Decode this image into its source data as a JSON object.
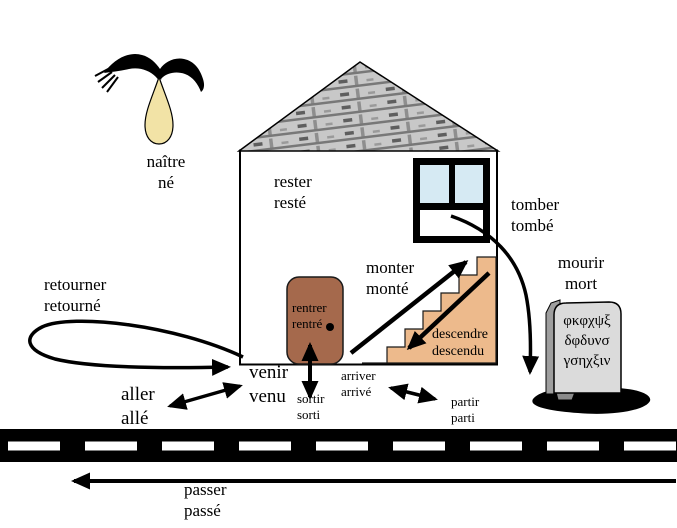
{
  "verbs": {
    "naitre": {
      "inf": "naître",
      "pp": "né"
    },
    "rester": {
      "inf": "rester",
      "pp": "resté"
    },
    "tomber": {
      "inf": "tomber",
      "pp": "tombé"
    },
    "monter": {
      "inf": "monter",
      "pp": "monté"
    },
    "descendre": {
      "inf": "descendre",
      "pp": "descendu"
    },
    "rentrer": {
      "inf": "rentrer",
      "pp": "rentré"
    },
    "sortir": {
      "inf": "sortir",
      "pp": "sorti"
    },
    "arriver": {
      "inf": "arriver",
      "pp": "arrivé"
    },
    "partir": {
      "inf": "partir",
      "pp": "parti"
    },
    "venir": {
      "inf": "venir",
      "pp": "venu"
    },
    "aller": {
      "inf": "aller",
      "pp": "allé"
    },
    "retourner": {
      "inf": "retourner",
      "pp": "retourné"
    },
    "mourir": {
      "inf": "mourir",
      "pp": "mort"
    },
    "passer": {
      "inf": "passer",
      "pp": "passé"
    }
  },
  "tombstone": {
    "line1": "φκφχψξ",
    "line2": "δφδυνσ",
    "line3": "γσηχξιν"
  },
  "icons": {
    "bird": "stork-carrying-baby-icon",
    "bundle": "baby-bundle-icon",
    "gravestone": "gravestone-icon",
    "house": "house-icon",
    "door": "door-icon",
    "window": "window-icon",
    "stairs": "staircase-icon",
    "road": "road-icon"
  },
  "colors": {
    "door": "#A5694C",
    "stairs": "#EDBA8C",
    "window_pane": "#D6EAF3",
    "bundle": "#F2E3A6",
    "stone_face": "#DBDBDB",
    "stone_side": "#9E9E9E",
    "roof_base": "#C8C8C8",
    "roof_gap": "#787878",
    "road": "#000000",
    "road_dash": "#FFFFFF",
    "ink": "#000000"
  }
}
